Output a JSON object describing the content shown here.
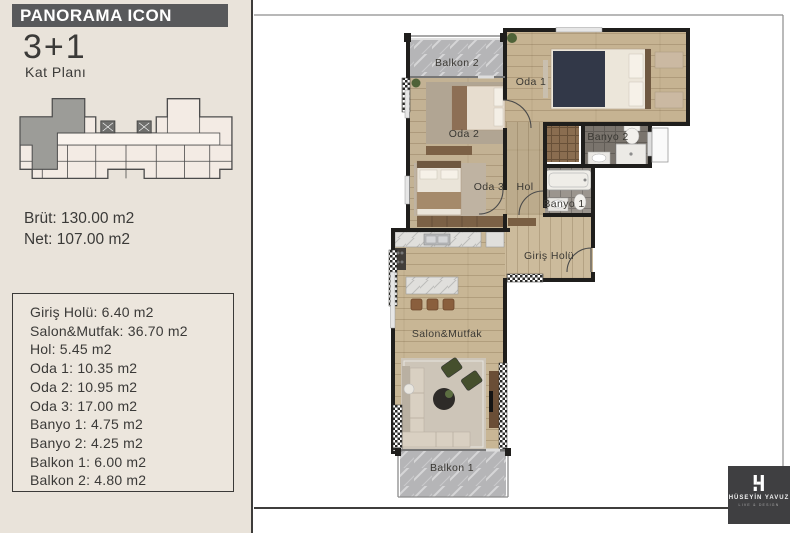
{
  "sidebar": {
    "brand": "PANORAMA ICON",
    "plan_type": "3+1",
    "plan_subtitle": "Kat Planı",
    "brut": "Brüt: 130.00 m2",
    "net": "Net: 107.00 m2"
  },
  "areas": {
    "rooms": [
      {
        "name": "Giriş Holü",
        "area": "6.40 m2"
      },
      {
        "name": "Salon&Mutfak",
        "area": "36.70 m2"
      },
      {
        "name": "Hol",
        "area": "5.45 m2"
      },
      {
        "name": "Oda 1",
        "area": "10.35 m2"
      },
      {
        "name": "Oda 2",
        "area": "10.95 m2"
      },
      {
        "name": "Oda 3",
        "area": "17.00 m2"
      },
      {
        "name": "Banyo 1",
        "area": "4.75 m2"
      },
      {
        "name": "Banyo 2",
        "area": "4.25 m2"
      },
      {
        "name": "Balkon 1",
        "area": "6.00 m2"
      },
      {
        "name": "Balkon 2",
        "area": "4.80 m2"
      }
    ]
  },
  "plan_labels": {
    "balkon2": "Balkon 2",
    "oda1": "Oda 1",
    "oda2": "Oda 2",
    "banyo2": "Banyo 2",
    "oda3": "Oda 3",
    "hol": "Hol",
    "banyo1": "Banyo 1",
    "giris_holu": "Giriş Holü",
    "salon_mutfak": "Salon&Mutfak",
    "balkon1": "Balkon 1"
  },
  "logo": {
    "name": "HÜSEYİN YAVUZ",
    "tagline": "LIVE & DESIGN"
  },
  "colors": {
    "sidebar_bg": "#e9e3da",
    "banner_bg": "#58595b",
    "text": "#3b3a38",
    "wall": "#1f1e1c",
    "wood_floor": "#c7b494",
    "balcony_floor": "#b5b5b7",
    "bath_dark_floor": "#7a746d",
    "bath_light_floor": "#9b958e",
    "logo_bg": "#3f3f41",
    "highlight_unit": "#9c9c98"
  }
}
